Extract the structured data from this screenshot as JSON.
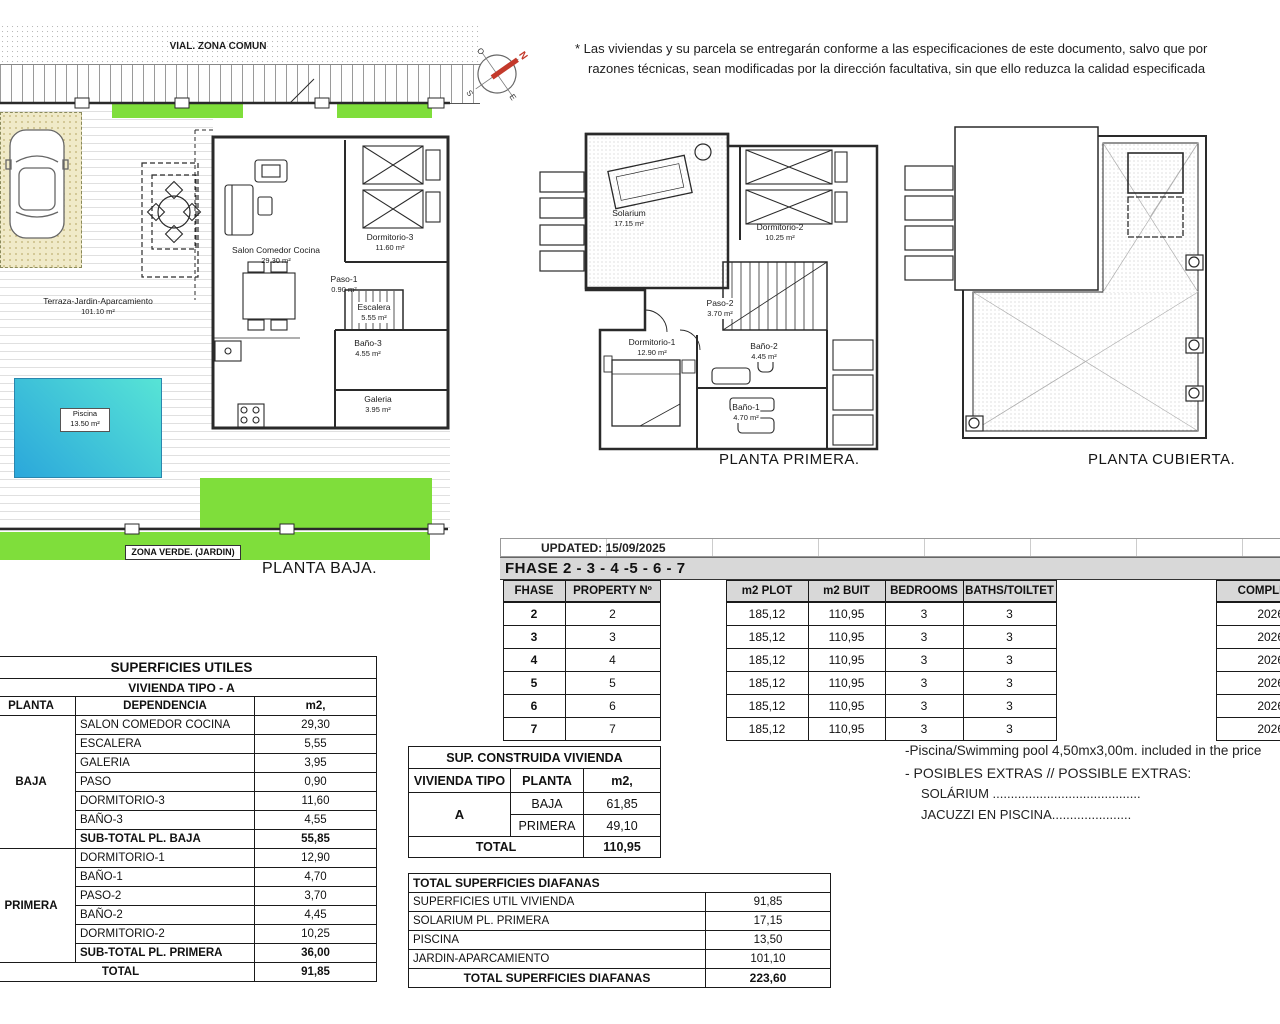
{
  "disclaimer": {
    "line1": "* Las viviendas y su parcela se entregarán conforme a las especificaciones de este documento, salvo que por",
    "line2": "razones técnicas, sean modificadas por la dirección facultativa, sin que ello reduzca la calidad especificada"
  },
  "compass": {
    "n": "N",
    "s": "S",
    "e": "E",
    "o": "O"
  },
  "plans": {
    "baja": {
      "title": "PLANTA BAJA.",
      "street_label": "VIAL. ZONA COMUN",
      "zona_verde_label": "ZONA  VERDE. (JARDIN)",
      "terraza": {
        "name": "Terraza-Jardin-Aparcamiento",
        "area": "101.10 m²"
      },
      "piscina": {
        "name": "Piscina",
        "area": "13.50 m²"
      },
      "rooms": [
        {
          "name": "Salon  Comedor  Cocina",
          "area": "29.30 m²"
        },
        {
          "name": "Dormitorio-3",
          "area": "11.60 m²"
        },
        {
          "name": "Paso-1",
          "area": "0.90 m²"
        },
        {
          "name": "Escalera",
          "area": "5.55 m²"
        },
        {
          "name": "Baño-3",
          "area": "4.55 m²"
        },
        {
          "name": "Galeria",
          "area": "3.95 m²"
        }
      ]
    },
    "primera": {
      "title": "PLANTA PRIMERA.",
      "rooms": [
        {
          "name": "Solarium",
          "area": "17.15 m²"
        },
        {
          "name": "Dormitorio-2",
          "area": "10.25 m²"
        },
        {
          "name": "Paso-2",
          "area": "3.70 m²"
        },
        {
          "name": "Dormitorio-1",
          "area": "12.90 m²"
        },
        {
          "name": "Baño-2",
          "area": "4.45 m²"
        },
        {
          "name": "Baño-1",
          "area": "4.70 m²"
        }
      ]
    },
    "cubierta": {
      "title": "PLANTA CUBIERTA."
    }
  },
  "phase_table": {
    "updated": "UPDATED: 15/09/2025",
    "band": "FHASE  2 - 3 - 4 -5 - 6 - 7",
    "headers": {
      "fhase": "FHASE",
      "property": "PROPERTY Nº",
      "m2_plot": "m2 PLOT",
      "m2_buit": "m2 BUIT",
      "bedrooms": "BEDROOMS",
      "baths": "BATHS/TOILTET",
      "completion": "COMPLETION"
    },
    "rows": [
      {
        "fhase": "2",
        "property": "2",
        "m2_plot": "185,12",
        "m2_buit": "110,95",
        "bedrooms": "3",
        "baths": "3",
        "completion": "2026-2"
      },
      {
        "fhase": "3",
        "property": "3",
        "m2_plot": "185,12",
        "m2_buit": "110,95",
        "bedrooms": "3",
        "baths": "3",
        "completion": "2026-2"
      },
      {
        "fhase": "4",
        "property": "4",
        "m2_plot": "185,12",
        "m2_buit": "110,95",
        "bedrooms": "3",
        "baths": "3",
        "completion": "2026-2"
      },
      {
        "fhase": "5",
        "property": "5",
        "m2_plot": "185,12",
        "m2_buit": "110,95",
        "bedrooms": "3",
        "baths": "3",
        "completion": "2026-2"
      },
      {
        "fhase": "6",
        "property": "6",
        "m2_plot": "185,12",
        "m2_buit": "110,95",
        "bedrooms": "3",
        "baths": "3",
        "completion": "2026-2"
      },
      {
        "fhase": "7",
        "property": "7",
        "m2_plot": "185,12",
        "m2_buit": "110,95",
        "bedrooms": "3",
        "baths": "3",
        "completion": "2026-2"
      }
    ]
  },
  "superficies_utiles": {
    "title": "SUPERFICIES UTILES",
    "subtitle": "VIVIENDA TIPO - A",
    "headers": {
      "planta": "PLANTA",
      "dependencia": "DEPENDENCIA",
      "m2": "m2,"
    },
    "baja_label": "BAJA",
    "baja_rows": [
      [
        "SALON COMEDOR COCINA",
        "29,30"
      ],
      [
        "ESCALERA",
        "5,55"
      ],
      [
        "GALERIA",
        "3,95"
      ],
      [
        "PASO",
        "0,90"
      ],
      [
        "DORMITORIO-3",
        "11,60"
      ],
      [
        "BAÑO-3",
        "4,55"
      ]
    ],
    "baja_subtotal": [
      "SUB-TOTAL PL. BAJA",
      "55,85"
    ],
    "primera_label": "PRIMERA",
    "primera_rows": [
      [
        "DORMITORIO-1",
        "12,90"
      ],
      [
        "BAÑO-1",
        "4,70"
      ],
      [
        "PASO-2",
        "3,70"
      ],
      [
        "BAÑO-2",
        "4,45"
      ],
      [
        "DORMITORIO-2",
        "10,25"
      ]
    ],
    "primera_subtotal": [
      "SUB-TOTAL PL. PRIMERA",
      "36,00"
    ],
    "total": [
      "TOTAL",
      "91,85"
    ]
  },
  "construida": {
    "title": "SUP. CONSTRUIDA VIVIENDA",
    "headers": [
      "VIVIENDA TIPO",
      "PLANTA",
      "m2,"
    ],
    "tipo": "A",
    "rows": [
      [
        "BAJA",
        "61,85"
      ],
      [
        "PRIMERA",
        "49,10"
      ]
    ],
    "total": [
      "TOTAL",
      "110,95"
    ]
  },
  "diafanas": {
    "title": "TOTAL SUPERFICIES DIAFANAS",
    "rows": [
      [
        "SUPERFICIES UTIL VIVIENDA",
        "91,85"
      ],
      [
        "SOLARIUM PL. PRIMERA",
        "17,15"
      ],
      [
        "PISCINA",
        "13,50"
      ],
      [
        "JARDIN-APARCAMIENTO",
        "101,10"
      ]
    ],
    "total": [
      "TOTAL SUPERFICIES DIAFANAS",
      "223,60"
    ]
  },
  "extras": {
    "pool_line": "-Piscina/Swimming pool 4,50mx3,00m. included in the price",
    "extras_line": "- POSIBLES EXTRAS // POSSIBLE EXTRAS:",
    "item1": "SOLÁRIUM .........................................",
    "item2": "JACUZZI EN PISCINA......................"
  },
  "colors": {
    "green": "#7FDE3B",
    "pool_start": "#57E4D6",
    "pool_end": "#2BA7DB",
    "table_gray": "#D8D8D8",
    "parking_beige": "#F0EAC8",
    "north_red": "#C3392B"
  }
}
